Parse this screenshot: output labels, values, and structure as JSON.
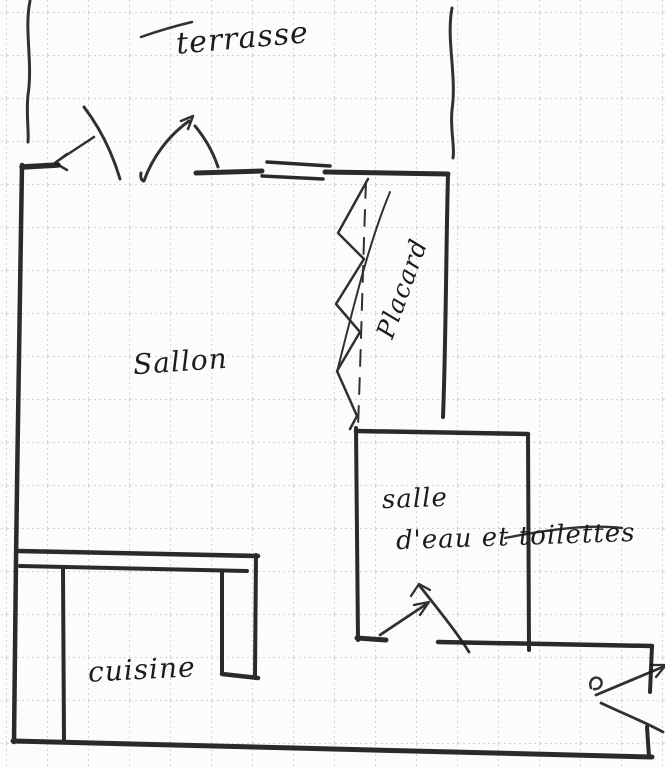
{
  "document": {
    "kind": "hand-drawn floor plan sketch on squared grid paper"
  },
  "palette": {
    "paper": "#fcfcfa",
    "grid_line": "#9aa0b4",
    "ink": "#1a1a1a"
  },
  "labels": {
    "terrace": "terrasse",
    "living_room": "Sallon",
    "closet": "Placard",
    "bathroom_line1": "salle",
    "bathroom_line2": "d'eau et toilettes",
    "kitchen": "cuisine"
  }
}
